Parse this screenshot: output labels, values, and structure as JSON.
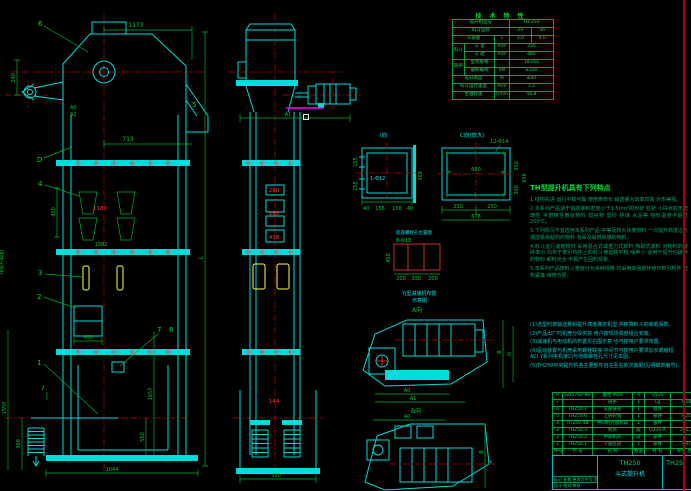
{
  "front_view": {
    "balloons": {
      "b6": "6",
      "bD": "D",
      "b4": "4",
      "b3": "3",
      "b2": "2",
      "b1": "1",
      "b7": "7",
      "b8": "8",
      "b5": "5",
      "sec": "I"
    },
    "dims": {
      "top_width": "1173",
      "d240": "240",
      "a0": "A0",
      "a1": "A1",
      "d713": "713",
      "d450": "450",
      "d1180": "1180",
      "d1382": "1382",
      "d400": "400",
      "d300": "300",
      "d1550": "1550",
      "d550": "550",
      "d1657": "1657",
      "bottom_width": "1044",
      "total": "L",
      "height_note": "H(提升高度)"
    }
  },
  "side_view": {
    "dims": {
      "a1": "A1",
      "d280": "280",
      "d180": "180",
      "d438": "438",
      "d144": "144",
      "bottom": "520"
    }
  },
  "detail_i": {
    "title": "I向",
    "note": "1-Φ12",
    "dims": {
      "left1": "155",
      "left2": "155",
      "right": "360",
      "b1": "40",
      "b2": "156",
      "b3": "156",
      "b4": "40"
    }
  },
  "detail_c": {
    "title": "C向(放大)",
    "holes": "12-Φ14",
    "dims": {
      "inner": "600",
      "b1": "250",
      "b2": "250",
      "bottom": "678",
      "r1": "350",
      "r2": "300",
      "right": "656"
    }
  },
  "bolt_plan": {
    "title": "底座螺栓孔位置图",
    "holes": "8-Φ18",
    "dims": {
      "v": "450",
      "h1": "200",
      "h2": "300",
      "h3": "200"
    }
  },
  "drive_views": {
    "caption1": "YJ型减速机布置",
    "caption2": "示意图",
    "view_a": "A向",
    "view_b": "B向",
    "dims": {
      "a0": "A0",
      "a1": "A1",
      "a0b": "A0",
      "b": "B",
      "h": "H",
      "a": "a"
    }
  },
  "spec_table": {
    "title": "技 术 特 性",
    "rows": {
      "r1l": "提升机型号",
      "r1v": "TH 250",
      "r2l": "料斗型式",
      "r2v1": "Zh",
      "r2v2": "Sh",
      "r3l": "斗容量",
      "r3u": "L",
      "r3v1": "3.0",
      "r3v2": "4.0",
      "g1": "料斗",
      "r4l": "斗 宽",
      "r4u": "mm",
      "r4v": "250",
      "r5l": "斗 距",
      "r5u": "mm",
      "r5v": "480",
      "g2": "链条",
      "r6l": "型式规格",
      "r6u": "",
      "r6v": "18×64",
      "r7l": "破断载荷",
      "r7u": "kN",
      "r7v": "≥320",
      "r8l": "提升高度",
      "r8u": "m",
      "r8v": "≤40",
      "r9l": "料斗运行速度",
      "r9u": "m/s",
      "r9v": "1.2",
      "r10l": "主轴转速",
      "r10u": "r/min",
      "r10v": "44.8"
    }
  },
  "features": {
    "title": "TH型提升机具有下列特点",
    "lines": [
      "1.结构先进 运行平稳可靠 使用寿命长 输送量大效率较高 外形美观。",
      "2.本系列产品适于输送堆积密度小于1.5t/m³的粉状 粒状 小块状的无磨琢性 半磨琢性散状物料 如谷物 型砂 碎煤 水泥等 物料温度不超过250℃。",
      "3.下列情况不宜选用本系列产品 中等及较大块度物料 一次提升高度过大 潮湿极易粘附的物料 有毒及易燃易爆的物料。",
      "4.料斗运行速度较低 采用混合式或重力式卸料 掏取式装料 对物料的破碎率小 均布于牵引构件上的料斗使运转平稳 噪声小 适用于提升怕破碎的物料 卸料完全 不易产生回料现象。",
      "5.本系列产品按料斗宽度分为多种规格 均采用高强度环链作牵引构件 结构紧凑 维修方便。"
    ]
  },
  "notes": {
    "lines": [
      "(1)选型时按输送量和提升高度确定机型 并核算料斗的装载系数。",
      "(2)产品出厂时机壳分段供货 用户按现场高度组合安装。",
      "(3)减速机与电动机的布置见右图示意 也可按用户要求布置。",
      "(4)驱动装置与机壳采用螺栓联接 中间节可按用户要求加长或缩短 ACI,Y系列电机接口与地脚螺栓孔尺寸见本图。",
      "(5)TH250中央提升机各主要部件自左至右依次装配(见明细表编号)。"
    ]
  },
  "bom": {
    "header": {
      "no": "件号",
      "code": "代  号",
      "name": "名  称",
      "qty": "数量",
      "mat": "材  料",
      "wt": "单件 总计"
    },
    "rows": [
      {
        "no": "8",
        "code": "GB5782-88",
        "name": "螺栓 M20",
        "qty": "4",
        "mat": "Q235",
        "wt": ""
      },
      {
        "no": "7",
        "code": "",
        "name": "链条",
        "qty": "1",
        "mat": "Lg",
        "wt": "9.06"
      },
      {
        "no": "6",
        "code": "TH250.7",
        "name": "头部链轮",
        "qty": "1",
        "mat": "组件",
        "wt": ""
      },
      {
        "no": "5",
        "code": "TH250.6",
        "name": "上链轮组",
        "qty": "1",
        "mat": "部件",
        "wt": "025"
      },
      {
        "no": "4",
        "code": "TH250.4B",
        "name": "中间机壳加长段",
        "qty": "1",
        "mat": "部件",
        "wt": ""
      },
      {
        "no": "3",
        "code": "TH250.3",
        "name": "机壳",
        "qty": "段",
        "mat": "Q235-A",
        "wt": "205.2"
      },
      {
        "no": "2",
        "code": "TH250.2",
        "name": "中部机壳",
        "qty": "段",
        "mat": "部件",
        "wt": ""
      },
      {
        "no": "1",
        "code": "TH250.1",
        "name": "下部区段",
        "qty": "1",
        "mat": "部件",
        "wt": "087"
      }
    ]
  },
  "title_block": {
    "model": "TH250",
    "name": "斗式提升机",
    "right_model": "TH25",
    "rev_row": "标记 处数 更改文件号 签字 日期",
    "sig_row": "设计  校对  审核"
  }
}
